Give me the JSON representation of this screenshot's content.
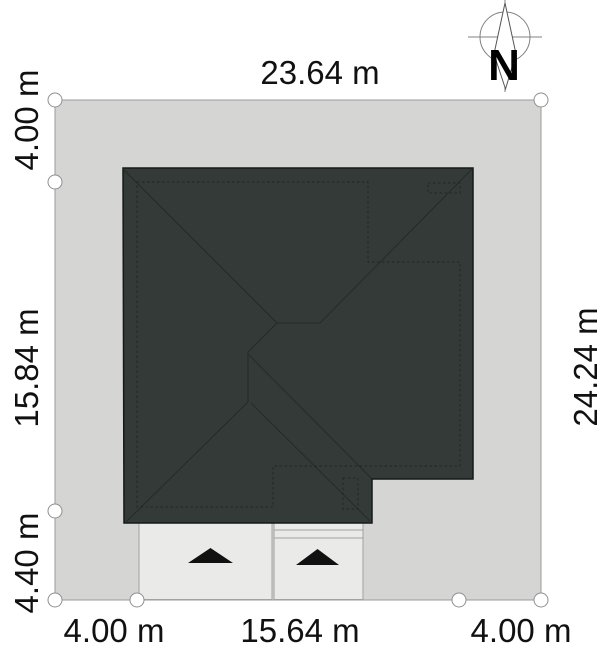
{
  "title": "house-site-plan",
  "dimensions": {
    "top": "23.64 m",
    "left_top": "4.00 m",
    "left_middle": "15.84 m",
    "left_bottom": "4.40 m",
    "right": "24.24 m",
    "bottom_left": "4.00 m",
    "bottom_middle": "15.64 m",
    "bottom_right": "4.00 m"
  },
  "compass": {
    "label": "N"
  },
  "colors": {
    "background": "#ffffff",
    "plot_fill": "#d5d5d3",
    "plot_stroke": "#9b9b9b",
    "roof_fill": "#333a37",
    "roof_stroke": "#15191a",
    "roof_line": "#242b28",
    "wall_dash": "#1f2523",
    "apron_fill": "#eaeae8",
    "apron_stroke": "#a2a2a0",
    "marker_stroke": "#8f8f8f",
    "text_color": "#111111",
    "arrow_fill": "#111111",
    "compass_stroke": "#808080"
  }
}
